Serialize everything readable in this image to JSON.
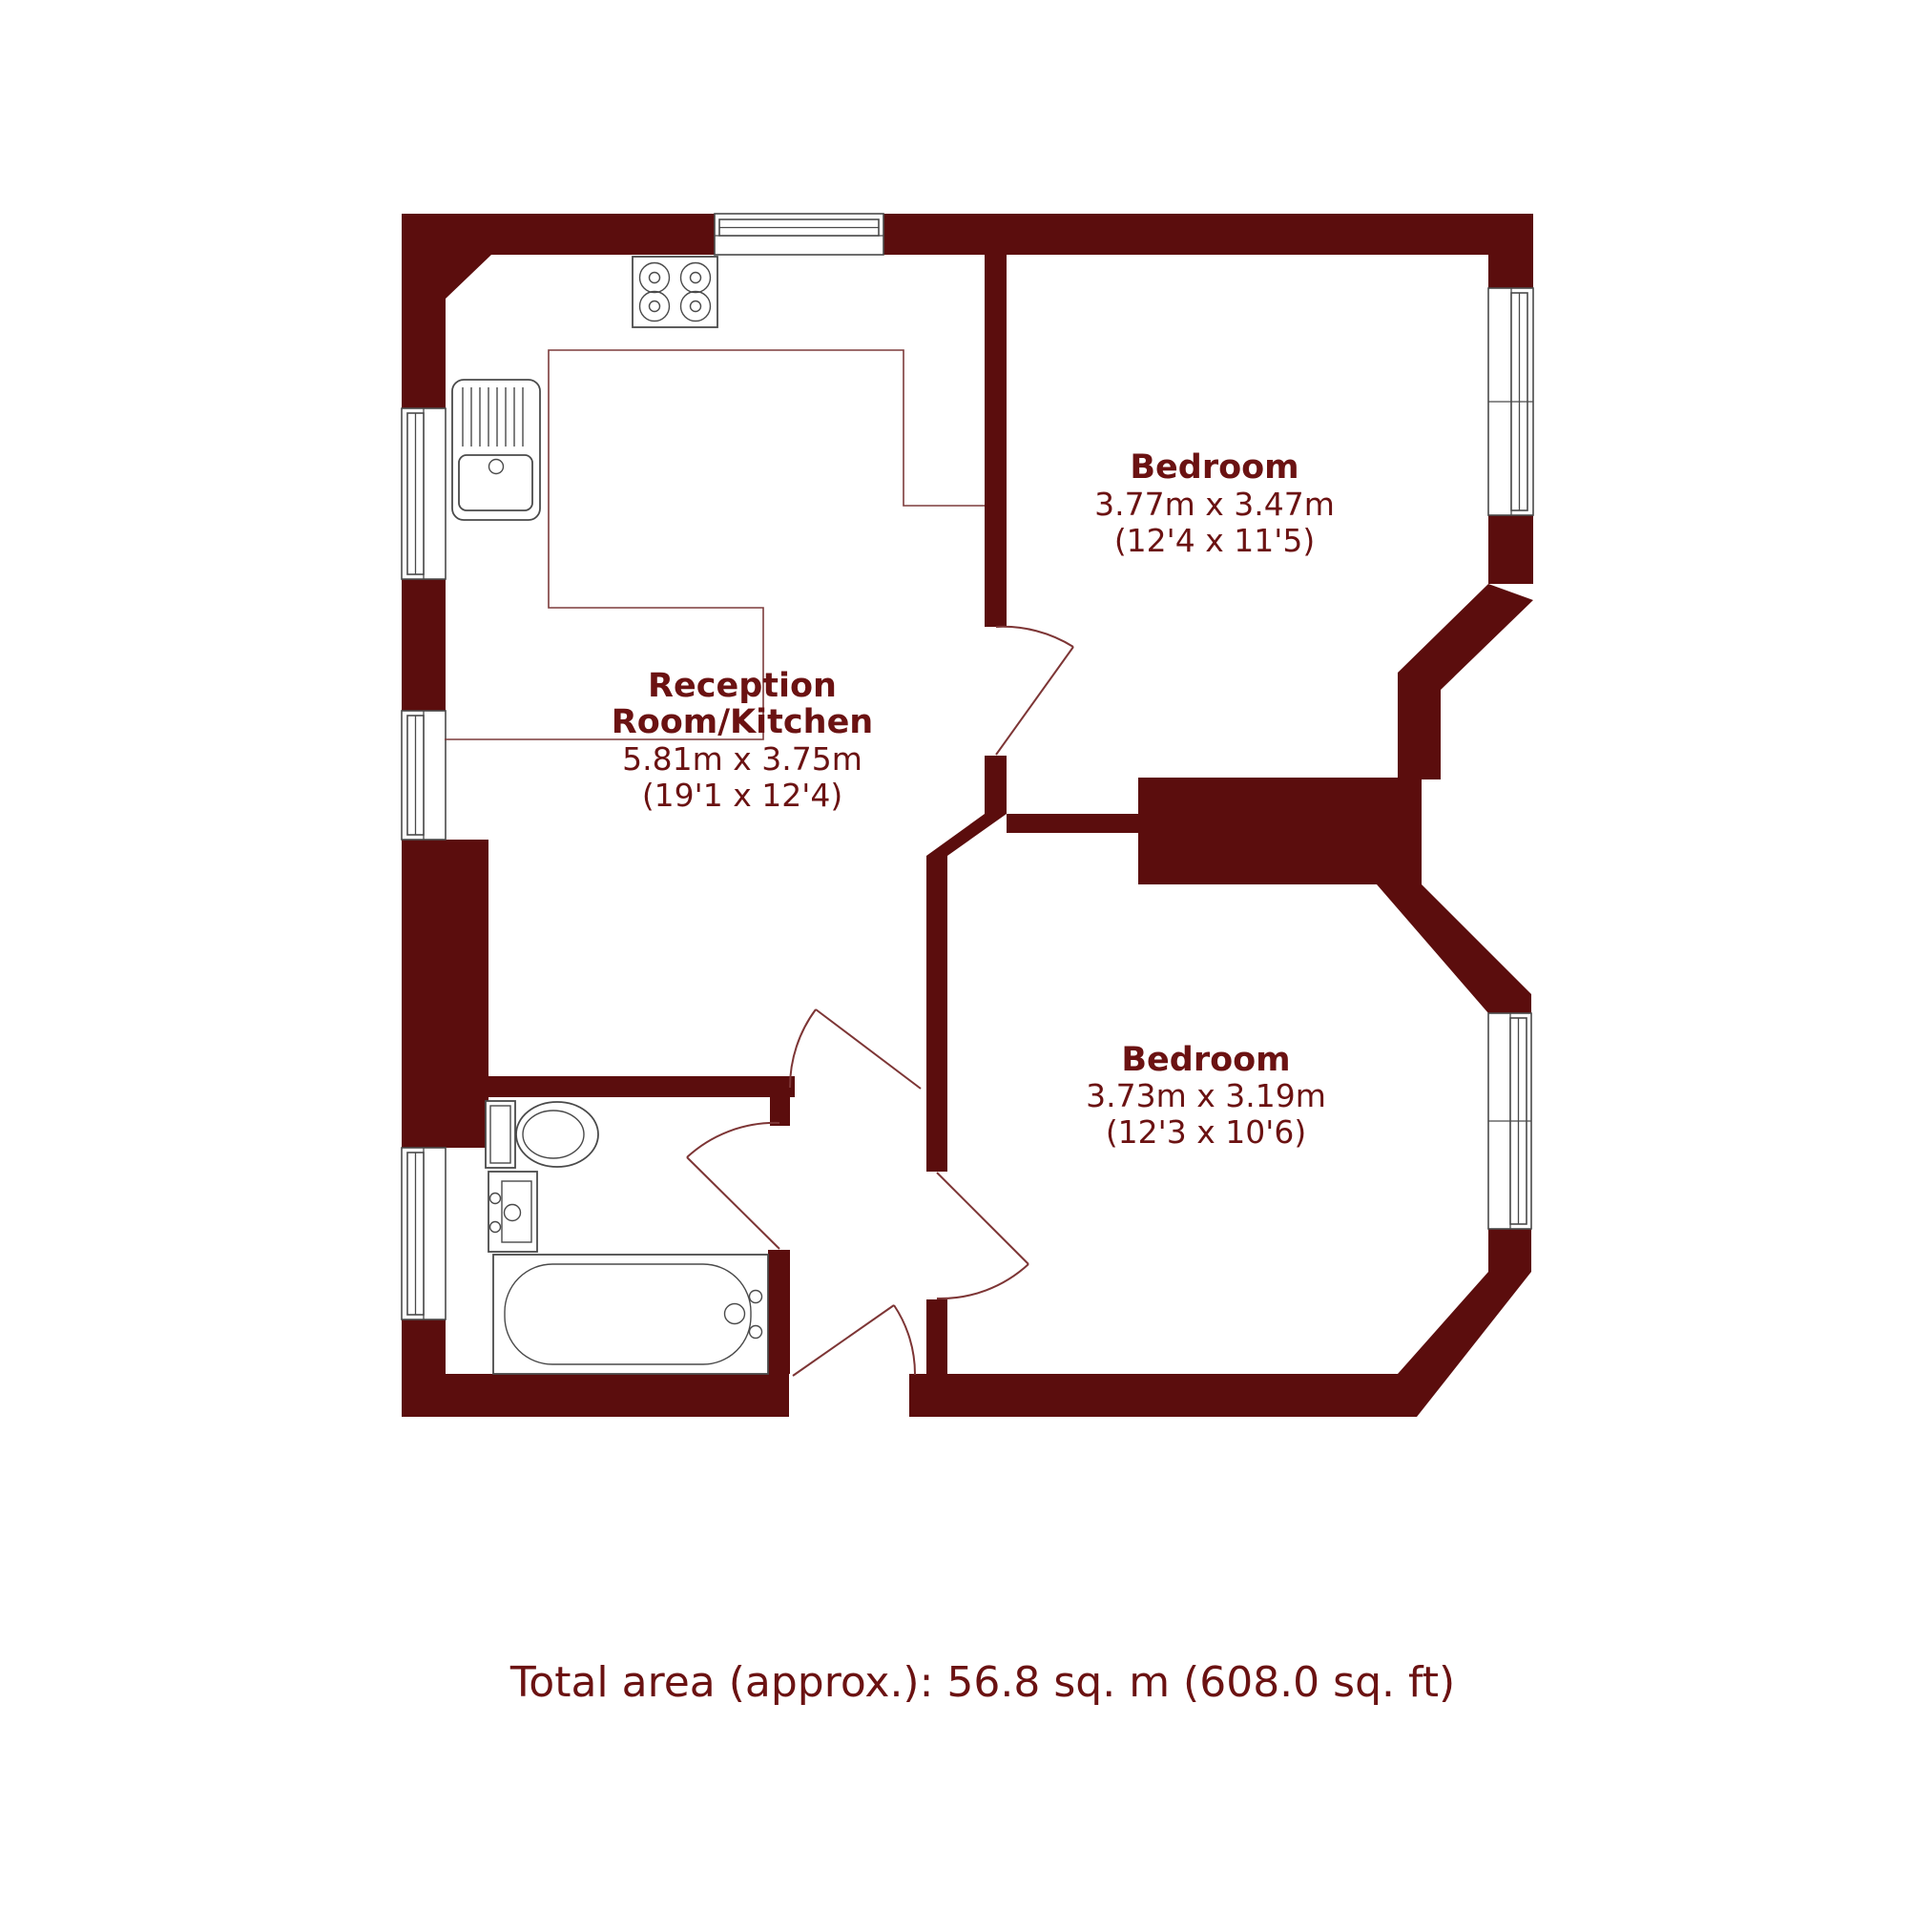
{
  "floorplan": {
    "type": "property-floor-plan",
    "rooms": [
      {
        "id": "bedroom-top",
        "name": "Bedroom",
        "size_metric": "3.77m x 3.47m",
        "size_imperial": "(12'4 x 11'5)"
      },
      {
        "id": "reception-kitchen",
        "name_line1": "Reception",
        "name_line2": "Room/Kitchen",
        "size_metric": "5.81m x 3.75m",
        "size_imperial": "(19'1 x 12'4)"
      },
      {
        "id": "bedroom-bottom",
        "name": "Bedroom",
        "size_metric": "3.73m x 3.19m",
        "size_imperial": "(12'3 x 10'6)"
      }
    ],
    "footer": {
      "total_area": "Total area (approx.): 56.8 sq. m (608.0 sq. ft)"
    },
    "fixtures": [
      "hob-icon",
      "kitchen-sink-icon",
      "toilet-icon",
      "bathroom-basin-icon",
      "bathtub-icon"
    ],
    "features": {
      "windows": 6,
      "doors": 5,
      "bay_windows": 2
    },
    "colors": {
      "wall": "#5b0d0d",
      "door_line": "#7d3535",
      "floor_line": "#7d3b3b",
      "fixture_line": "#4a4a4a",
      "label_text": "#6b1212",
      "background": "#ffffff"
    }
  }
}
